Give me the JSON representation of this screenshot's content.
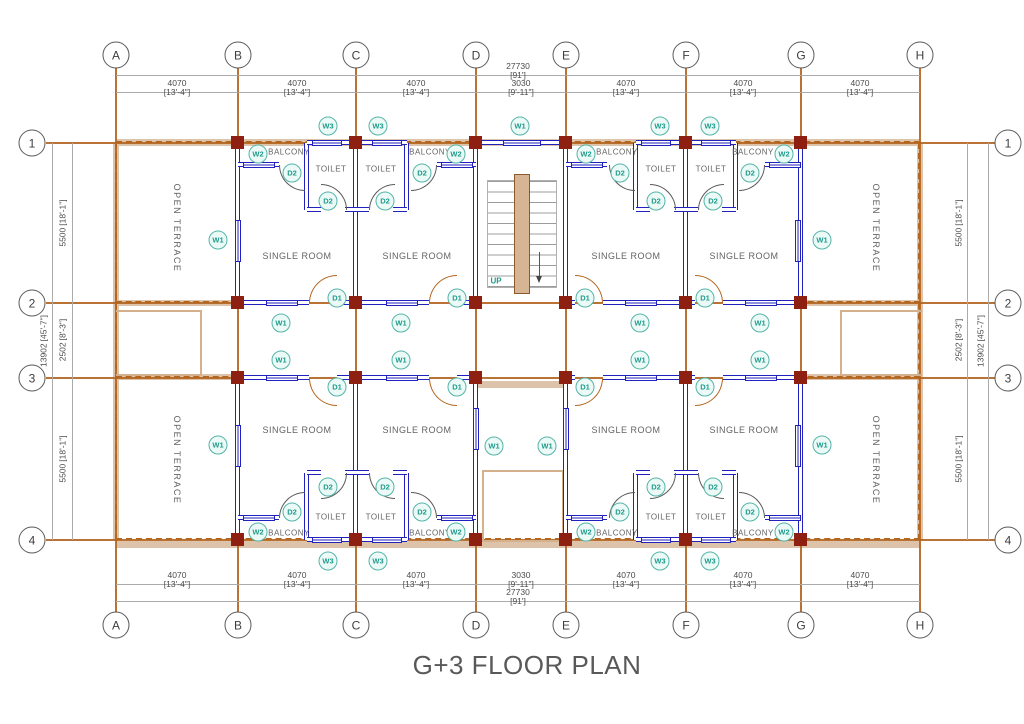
{
  "title": "G+3 FLOOR PLAN",
  "grid": {
    "cols": [
      "A",
      "B",
      "C",
      "D",
      "E",
      "F",
      "G",
      "H"
    ],
    "rows": [
      "1",
      "2",
      "3",
      "4"
    ]
  },
  "dims": {
    "h_seg_mm": "4070",
    "h_seg_ft": "[13'-4\"]",
    "h_mid_mm": "3030",
    "h_mid_ft": "[9'-11\"]",
    "h_overall_mm": "27730",
    "h_overall_ft": "[91']",
    "v_big_mm": "5500",
    "v_big_ft": "[18'-1\"]",
    "v_small_mm": "2502",
    "v_small_ft": "[8'-3\"]",
    "v_overall_mm": "13902",
    "v_overall_ft": "[45'-7\"]"
  },
  "labels": {
    "single_room": "SINGLE ROOM",
    "toilet": "TOILET",
    "balcony": "BALCONY",
    "open_terrace": "OPEN TERRACE",
    "up": "UP"
  },
  "tags": {
    "w1": "W1",
    "w2": "W2",
    "w3": "W3",
    "d1": "D1",
    "d2": "D2"
  },
  "colors": {
    "wall": "#2121bd",
    "column": "#8e2012",
    "grid_line": "#b4651e",
    "parapet_band": "#dcc3a9",
    "door_d1": "#b5651e",
    "door_d2": "#5a5a5a",
    "tag_teal": "#1c9a8a",
    "dim_text": "#4b4b4b",
    "title_text": "#595959"
  }
}
